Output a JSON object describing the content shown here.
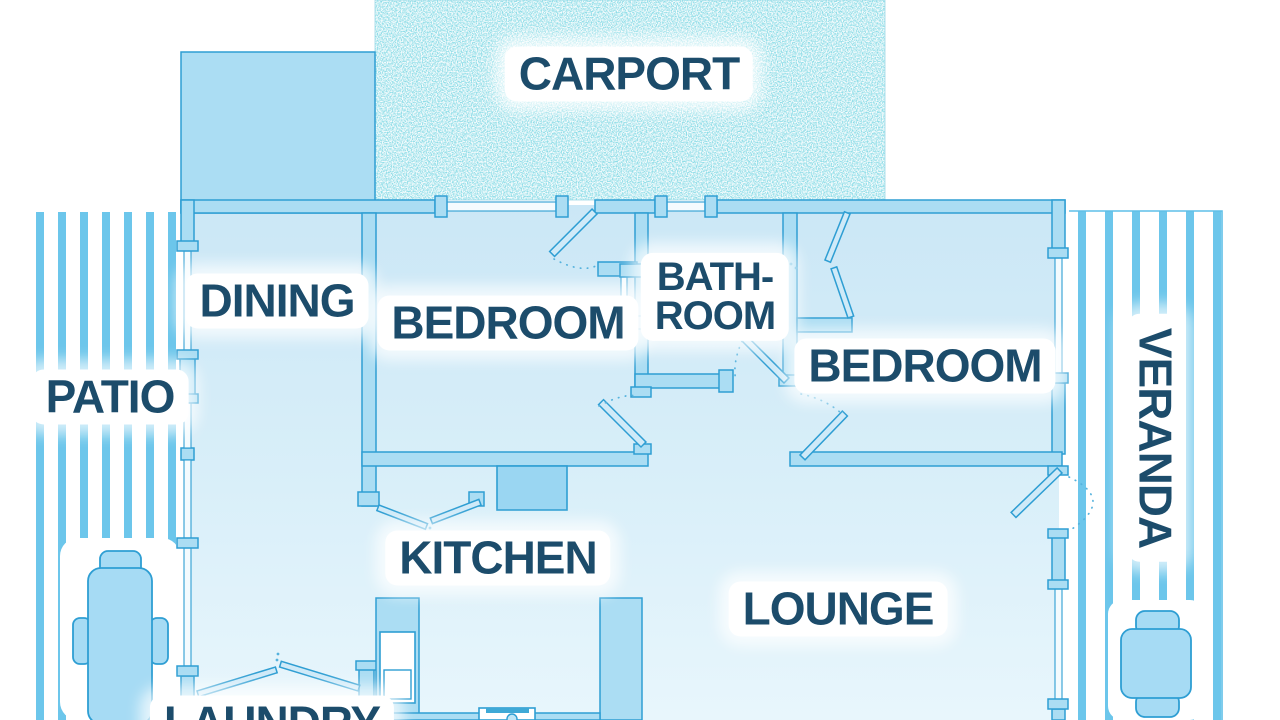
{
  "image_type": "residential floor plan, blue line-art style",
  "rooms": {
    "carport": {
      "label": "CARPORT"
    },
    "dining": {
      "label": "DINING"
    },
    "bedroom_left": {
      "label": "BEDROOM"
    },
    "bathroom": {
      "line1": "BATH-",
      "line2": "ROOM"
    },
    "bedroom_right": {
      "label": "BEDROOM"
    },
    "patio": {
      "label": "PATIO"
    },
    "kitchen": {
      "label": "KITCHEN"
    },
    "lounge": {
      "label": "LOUNGE"
    },
    "veranda": {
      "label": "VERANDA"
    },
    "laundry": {
      "label": "LAUNDRY"
    }
  },
  "colors": {
    "wall_fill": "#abddf3",
    "wall_stroke": "#2e9ed3",
    "room_fill_top": "#cbe7f6",
    "room_fill_bottom": "#e8f6fc",
    "deck_stripe": "#6cc6eb",
    "carport_speckle": "#45b8cc",
    "label_text": "#1c4c6b",
    "label_bg": "#ffffff",
    "furniture_fill": "#a6dbf4",
    "appliance_fill": "#9ad6f2"
  },
  "furniture": {
    "patio": "rectangular table with three chairs",
    "veranda": "square table with two chairs",
    "kitchen": [
      "left counter with refrigerator",
      "wall appliance block",
      "right counter",
      "sink with faucet"
    ]
  }
}
